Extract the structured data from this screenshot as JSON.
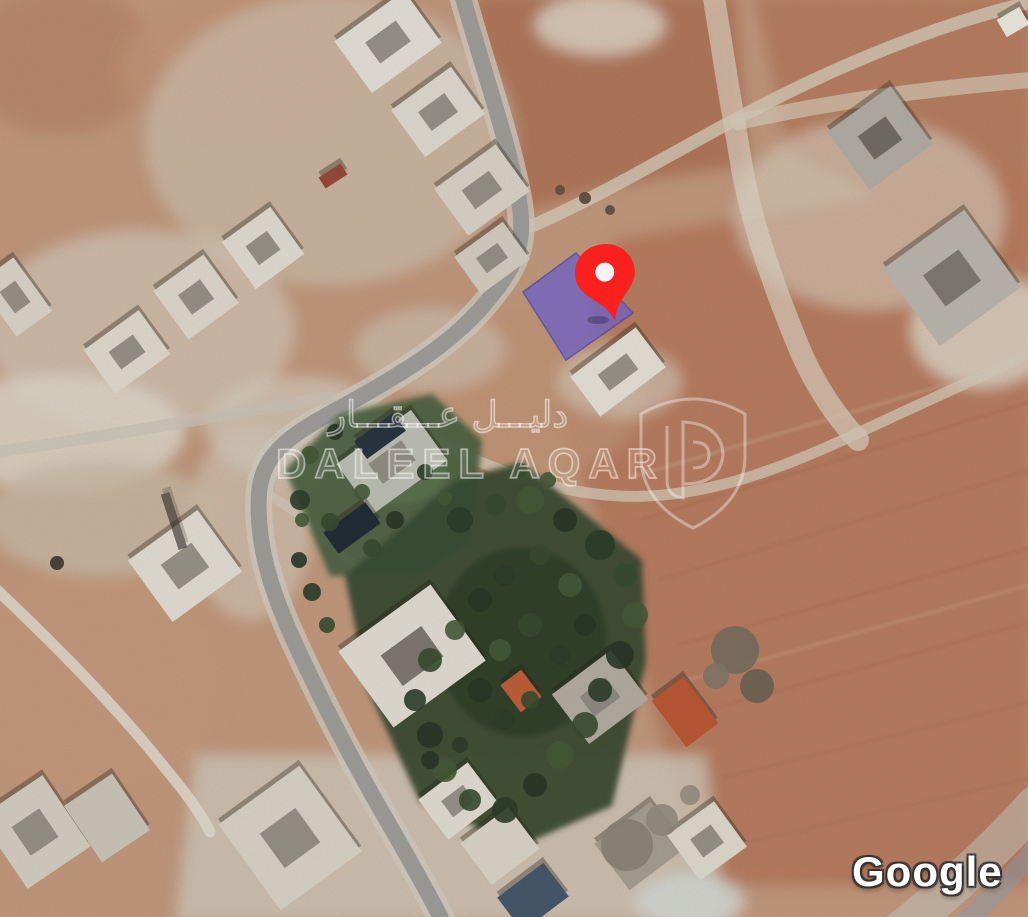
{
  "canvas": {
    "w": 1028,
    "h": 917,
    "base_color": "#c69c80"
  },
  "watermark": {
    "arabic": "دليـــل عـــقـــار",
    "english": "DALEEL AQAR",
    "color": "#ffffff"
  },
  "attribution": {
    "text": "Google"
  },
  "marker": {
    "x": 606,
    "y": 278,
    "rot": -12,
    "color": "#f9201d",
    "hole_color": "#f6f3f6"
  },
  "parcel": {
    "points": "523,292 576,253 633,313 566,360",
    "fill": "#7063c2",
    "stroke": "#4f46a0",
    "opacity": 0.8
  },
  "map": {
    "terrain": [
      {
        "t": "e",
        "x": 60,
        "y": 60,
        "rx": 95,
        "ry": 75,
        "f": "#bd8a6c",
        "o": 0.85
      },
      {
        "t": "e",
        "x": 240,
        "y": 70,
        "rx": 120,
        "ry": 80,
        "f": "#c89a7c",
        "o": 0.7
      },
      {
        "t": "p",
        "pts": "470,-5 735,-5 748,165 615,185 515,215 495,120",
        "f": "#b2775a",
        "o": 0.9
      },
      {
        "t": "p",
        "pts": "755,-5 1032,-5 1032,250 895,205 788,152",
        "f": "#b87c5e",
        "o": 0.85
      },
      {
        "t": "p",
        "pts": "615,240 1032,170 1032,885 705,885 598,520 556,418",
        "f": "#bb7d60",
        "o": 0.95
      },
      {
        "t": "e",
        "x": 870,
        "y": 215,
        "rx": 135,
        "ry": 95,
        "f": "#ded5c5",
        "o": 0.6
      },
      {
        "t": "e",
        "x": 330,
        "y": 140,
        "rx": 185,
        "ry": 145,
        "f": "#d7cfc0",
        "o": 0.55
      },
      {
        "t": "e",
        "x": 140,
        "y": 330,
        "rx": 155,
        "ry": 100,
        "f": "#dcd5c7",
        "o": 0.6
      },
      {
        "t": "e",
        "x": 60,
        "y": 432,
        "rx": 125,
        "ry": 58,
        "f": "#e3dccd",
        "o": 0.85
      },
      {
        "t": "e",
        "x": 300,
        "y": 428,
        "rx": 95,
        "ry": 52,
        "f": "#dcd5c6",
        "o": 0.65
      },
      {
        "t": "p",
        "pts": "195,755 705,755 725,922 175,922",
        "f": "#d5cebf",
        "o": 0.8
      },
      {
        "t": "e",
        "x": 90,
        "y": 680,
        "rx": 135,
        "ry": 115,
        "f": "#c99d80",
        "o": 0.9
      },
      {
        "t": "e",
        "x": 520,
        "y": 395,
        "rx": 125,
        "ry": 85,
        "f": "#c59878",
        "o": 0.75
      },
      {
        "t": "e",
        "x": 983,
        "y": 330,
        "rx": 72,
        "ry": 58,
        "f": "#e4decf",
        "o": 0.8
      },
      {
        "t": "e",
        "x": 250,
        "y": 525,
        "rx": 62,
        "ry": 95,
        "f": "#d8d1c2",
        "o": 0.6
      },
      {
        "t": "e",
        "x": 600,
        "y": 25,
        "rx": 65,
        "ry": 30,
        "f": "#e6dfd0",
        "o": 0.8
      },
      {
        "t": "e",
        "x": 430,
        "y": 350,
        "rx": 75,
        "ry": 42,
        "f": "#d3cbbb",
        "o": 0.6
      },
      {
        "t": "e",
        "x": 620,
        "y": 382,
        "rx": 62,
        "ry": 36,
        "f": "#dcd5c6",
        "o": 0.6
      },
      {
        "t": "e",
        "x": 100,
        "y": 518,
        "rx": 115,
        "ry": 58,
        "f": "#cdbfa9",
        "o": 0.8
      },
      {
        "t": "e",
        "x": 690,
        "y": 902,
        "rx": 55,
        "ry": 28,
        "f": "#d9ddd8",
        "o": 0.85
      }
    ],
    "plow": [
      {
        "d": "M 640,520 L 1030,402",
        "c": "#a86a4f",
        "w": 3,
        "o": 0.3
      },
      {
        "d": "M 658,580 L 1030,470",
        "c": "#a86a4f",
        "w": 3,
        "o": 0.28
      },
      {
        "d": "M 678,645 L 1030,548",
        "c": "#a86a4f",
        "w": 3,
        "o": 0.3
      },
      {
        "d": "M 700,712 L 1030,622",
        "c": "#a86a4f",
        "w": 3,
        "o": 0.26
      },
      {
        "d": "M 722,778 L 1030,702",
        "c": "#a86a4f",
        "w": 3,
        "o": 0.28
      },
      {
        "d": "M 748,842 L 1030,778",
        "c": "#a86a4f",
        "w": 3,
        "o": 0.25
      },
      {
        "d": "M 628,478 L 1030,360",
        "c": "#d8b89a",
        "w": 4,
        "o": 0.3
      },
      {
        "d": "M 688,680 L 1030,585",
        "c": "#d8b89a",
        "w": 4,
        "o": 0.25
      }
    ],
    "roads": [
      {
        "d": "M 462,-6 C 480,60 505,130 518,195 C 526,238 520,262 488,300 C 456,340 408,370 358,398 C 300,430 263,447 259,493 C 256,540 269,586 293,639 C 319,696 353,763 393,831 C 413,866 430,896 443,922",
        "c": "#d7d1c5",
        "w": 27,
        "o": 0.75
      },
      {
        "d": "M 713,-8 C 722,50 732,110 742,168 C 752,225 775,290 800,350 C 815,385 835,415 858,440",
        "c": "#e3dbcb",
        "w": 22,
        "o": 0.65
      },
      {
        "d": "M 738,122 C 830,102 930,88 1032,80",
        "c": "#ded4c2",
        "w": 16,
        "o": 0.65
      },
      {
        "d": "M 532,226 C 600,196 660,160 725,125 C 800,84 880,48 960,22 C 985,14 1005,8 1032,2",
        "c": "#d9cfbc",
        "w": 13,
        "o": 0.8
      },
      {
        "d": "M 390,416 C 470,462 540,492 620,496 C 700,500 780,470 860,432 C 915,406 975,380 1032,352",
        "c": "#dacfbd",
        "w": 11,
        "o": 0.75
      },
      {
        "d": "M -5,452 C 70,442 150,428 230,414 C 265,408 300,402 332,398",
        "c": "#cfc8ba",
        "w": 12,
        "o": 0.7
      },
      {
        "d": "M -5,588 C 55,645 115,705 165,768 C 185,792 200,812 210,832",
        "c": "#e7e1d4",
        "w": 11,
        "o": 0.85
      },
      {
        "d": "M 898,932 C 945,895 990,855 1035,805",
        "c": "#ccd1ca",
        "w": 38,
        "o": 0.5
      },
      {
        "d": "M 958,928 C 995,895 1018,870 1038,845",
        "c": "#8fa5b9",
        "w": 20,
        "o": 0.45
      },
      {
        "d": "M 262,492 C 300,510 330,540 352,565",
        "c": "#d8d2c4",
        "w": 10,
        "o": 0.55
      },
      {
        "d": "M 462,-6 C 480,60 505,130 518,195 C 526,238 520,262 488,300 C 456,340 408,370 358,398 C 300,430 263,447 259,493 C 256,540 269,586 293,639 C 319,696 353,763 393,831 C 413,866 430,896 443,922",
        "c": "#a3a19d",
        "w": 16,
        "o": 1
      }
    ],
    "greens": [
      {
        "t": "p",
        "pts": "285,470 340,414 432,394 482,440 472,542 420,576 330,576",
        "f": "#4d6343",
        "o": 0.92
      },
      {
        "t": "e",
        "x": 398,
        "y": 472,
        "rx": 48,
        "ry": 32,
        "f": "#5b7850",
        "o": 0.8
      },
      {
        "t": "p",
        "pts": "345,576 455,480 522,462 642,560 646,662 612,806 520,846 420,802 368,690",
        "f": "#3b4e34",
        "o": 0.95
      },
      {
        "t": "e",
        "x": 522,
        "y": 642,
        "rx": 85,
        "ry": 95,
        "f": "#30412b",
        "o": 0.85
      }
    ],
    "buildings": [
      {
        "x": 388,
        "y": 42,
        "w": 86,
        "h": 64,
        "r": -36,
        "f": "#e9e5db",
        "i": 1
      },
      {
        "x": 438,
        "y": 112,
        "w": 74,
        "h": 58,
        "r": -36,
        "f": "#e4dfd3",
        "i": 1
      },
      {
        "x": 482,
        "y": 190,
        "w": 76,
        "h": 58,
        "r": -36,
        "f": "#ded8cb",
        "i": 1
      },
      {
        "x": 492,
        "y": 258,
        "w": 60,
        "h": 46,
        "r": -36,
        "f": "#d9d3c6",
        "i": 1
      },
      {
        "x": 333,
        "y": 176,
        "w": 26,
        "h": 13,
        "r": -33,
        "f": "#9a4b3d"
      },
      {
        "x": 263,
        "y": 248,
        "w": 60,
        "h": 58,
        "r": -36,
        "f": "#e7e2d7",
        "i": 1
      },
      {
        "x": 196,
        "y": 297,
        "w": 62,
        "h": 60,
        "r": -36,
        "f": "#e3ddd1",
        "i": 1
      },
      {
        "x": 127,
        "y": 352,
        "w": 68,
        "h": 54,
        "r": -36,
        "f": "#e5dfd2",
        "i": 1
      },
      {
        "x": 15,
        "y": 297,
        "w": 44,
        "h": 66,
        "r": -36,
        "f": "#e0dacd",
        "i": 1
      },
      {
        "x": 880,
        "y": 138,
        "w": 78,
        "h": 72,
        "r": -36,
        "f": "#b6b1a8",
        "i": "#68645c"
      },
      {
        "x": 952,
        "y": 278,
        "w": 100,
        "h": 96,
        "r": -36,
        "f": "#bfbab1",
        "i": "#76726a"
      },
      {
        "x": 1013,
        "y": 22,
        "w": 26,
        "h": 20,
        "r": -30,
        "f": "#f1ede3"
      },
      {
        "x": 618,
        "y": 372,
        "w": 82,
        "h": 50,
        "r": -37,
        "f": "#eae6db",
        "i": 1
      },
      {
        "x": 600,
        "y": 697,
        "w": 74,
        "h": 62,
        "r": -37,
        "f": "#b7b1a4",
        "i": 1
      },
      {
        "x": 685,
        "y": 712,
        "w": 40,
        "h": 58,
        "r": -37,
        "f": "#bf5a37"
      },
      {
        "x": 521,
        "y": 691,
        "w": 26,
        "h": 34,
        "r": -37,
        "f": "#c1613b"
      },
      {
        "x": 412,
        "y": 656,
        "w": 114,
        "h": 94,
        "r": -36,
        "f": "#e6e2d7",
        "i": "#6e6960"
      },
      {
        "x": 392,
        "y": 462,
        "w": 92,
        "h": 62,
        "r": -36,
        "f": "#c2c4b8",
        "i": 1
      },
      {
        "x": 352,
        "y": 528,
        "w": 52,
        "h": 26,
        "r": -36,
        "f": "#232e38"
      },
      {
        "x": 380,
        "y": 436,
        "w": 48,
        "h": 22,
        "r": -36,
        "f": "#2b3640"
      },
      {
        "x": 185,
        "y": 566,
        "w": 86,
        "h": 76,
        "r": -36,
        "f": "#e8e3d8",
        "i": 1
      },
      {
        "x": 174,
        "y": 521,
        "w": 9,
        "h": 58,
        "r": -18,
        "f": "#2e2c27",
        "o": 0.6
      },
      {
        "x": 290,
        "y": 838,
        "w": 100,
        "h": 106,
        "r": -36,
        "f": "#ded8cb",
        "i": 1
      },
      {
        "x": 35,
        "y": 832,
        "w": 76,
        "h": 86,
        "r": -34,
        "f": "#d9d3c6",
        "i": 1
      },
      {
        "x": 107,
        "y": 818,
        "w": 58,
        "h": 68,
        "r": -34,
        "f": "#d0cabd"
      },
      {
        "x": 458,
        "y": 801,
        "w": 62,
        "h": 50,
        "r": -37,
        "f": "#e7e2d6",
        "i": 1
      },
      {
        "x": 500,
        "y": 846,
        "w": 60,
        "h": 52,
        "r": -37,
        "f": "#e0dacd"
      },
      {
        "x": 533,
        "y": 897,
        "w": 58,
        "h": 42,
        "r": -37,
        "f": "#475a6e"
      },
      {
        "x": 640,
        "y": 846,
        "w": 70,
        "h": 58,
        "r": -37,
        "f": "#a9a294"
      },
      {
        "x": 707,
        "y": 841,
        "w": 58,
        "h": 56,
        "r": -36,
        "f": "#e4ded1",
        "i": 1
      }
    ],
    "trees": [
      {
        "x": 460,
        "y": 520,
        "r": 13
      },
      {
        "x": 495,
        "y": 505,
        "r": 11
      },
      {
        "x": 530,
        "y": 500,
        "r": 14
      },
      {
        "x": 565,
        "y": 520,
        "r": 12
      },
      {
        "x": 600,
        "y": 545,
        "r": 15
      },
      {
        "x": 625,
        "y": 575,
        "r": 12
      },
      {
        "x": 635,
        "y": 615,
        "r": 13
      },
      {
        "x": 620,
        "y": 655,
        "r": 14
      },
      {
        "x": 600,
        "y": 690,
        "r": 12
      },
      {
        "x": 585,
        "y": 725,
        "r": 13
      },
      {
        "x": 560,
        "y": 755,
        "r": 14
      },
      {
        "x": 535,
        "y": 785,
        "r": 12
      },
      {
        "x": 505,
        "y": 810,
        "r": 13
      },
      {
        "x": 470,
        "y": 800,
        "r": 11
      },
      {
        "x": 445,
        "y": 770,
        "r": 12
      },
      {
        "x": 430,
        "y": 735,
        "r": 13
      },
      {
        "x": 415,
        "y": 700,
        "r": 11
      },
      {
        "x": 430,
        "y": 660,
        "r": 12
      },
      {
        "x": 455,
        "y": 630,
        "r": 10
      },
      {
        "x": 480,
        "y": 600,
        "r": 12
      },
      {
        "x": 505,
        "y": 575,
        "r": 11
      },
      {
        "x": 540,
        "y": 555,
        "r": 10
      },
      {
        "x": 570,
        "y": 585,
        "r": 12
      },
      {
        "x": 585,
        "y": 625,
        "r": 11
      },
      {
        "x": 560,
        "y": 655,
        "r": 10
      },
      {
        "x": 530,
        "y": 625,
        "r": 12
      },
      {
        "x": 500,
        "y": 650,
        "r": 11
      },
      {
        "x": 480,
        "y": 690,
        "r": 12
      },
      {
        "x": 505,
        "y": 720,
        "r": 10
      },
      {
        "x": 530,
        "y": 700,
        "r": 9
      },
      {
        "x": 310,
        "y": 455,
        "r": 9
      },
      {
        "x": 335,
        "y": 432,
        "r": 8
      },
      {
        "x": 300,
        "y": 500,
        "r": 10
      },
      {
        "x": 330,
        "y": 522,
        "r": 9
      },
      {
        "x": 362,
        "y": 492,
        "r": 8
      },
      {
        "x": 395,
        "y": 520,
        "r": 9
      },
      {
        "x": 425,
        "y": 472,
        "r": 8
      },
      {
        "x": 372,
        "y": 548,
        "r": 9
      },
      {
        "x": 445,
        "y": 498,
        "r": 7
      },
      {
        "x": 299,
        "y": 560,
        "r": 8
      },
      {
        "x": 312,
        "y": 592,
        "r": 9
      },
      {
        "x": 327,
        "y": 625,
        "r": 8
      },
      {
        "x": 302,
        "y": 520,
        "r": 7
      },
      {
        "x": 430,
        "y": 760,
        "r": 9
      },
      {
        "x": 460,
        "y": 745,
        "r": 8
      },
      {
        "x": 520,
        "y": 470,
        "r": 7
      },
      {
        "x": 548,
        "y": 480,
        "r": 8
      },
      {
        "x": 735,
        "y": 650,
        "r": 24,
        "c": "#7a7062"
      },
      {
        "x": 757,
        "y": 686,
        "r": 17,
        "c": "#6f6557"
      },
      {
        "x": 716,
        "y": 676,
        "r": 13,
        "c": "#847a6c"
      },
      {
        "x": 627,
        "y": 845,
        "r": 26,
        "c": "#8d8578"
      },
      {
        "x": 662,
        "y": 820,
        "r": 16,
        "c": "#968e80"
      },
      {
        "x": 690,
        "y": 795,
        "r": 10,
        "c": "#9a9183"
      },
      {
        "x": 57,
        "y": 563,
        "r": 7,
        "c": "#3c3a33"
      },
      {
        "x": 585,
        "y": 198,
        "r": 6,
        "c": "#5a4a3c"
      },
      {
        "x": 610,
        "y": 210,
        "r": 5,
        "c": "#5f4f41"
      },
      {
        "x": 560,
        "y": 190,
        "r": 5,
        "c": "#64523f"
      }
    ],
    "tree_palette": [
      "#2e3f2a",
      "#3a4e31",
      "#465c38",
      "#2a3927"
    ]
  }
}
